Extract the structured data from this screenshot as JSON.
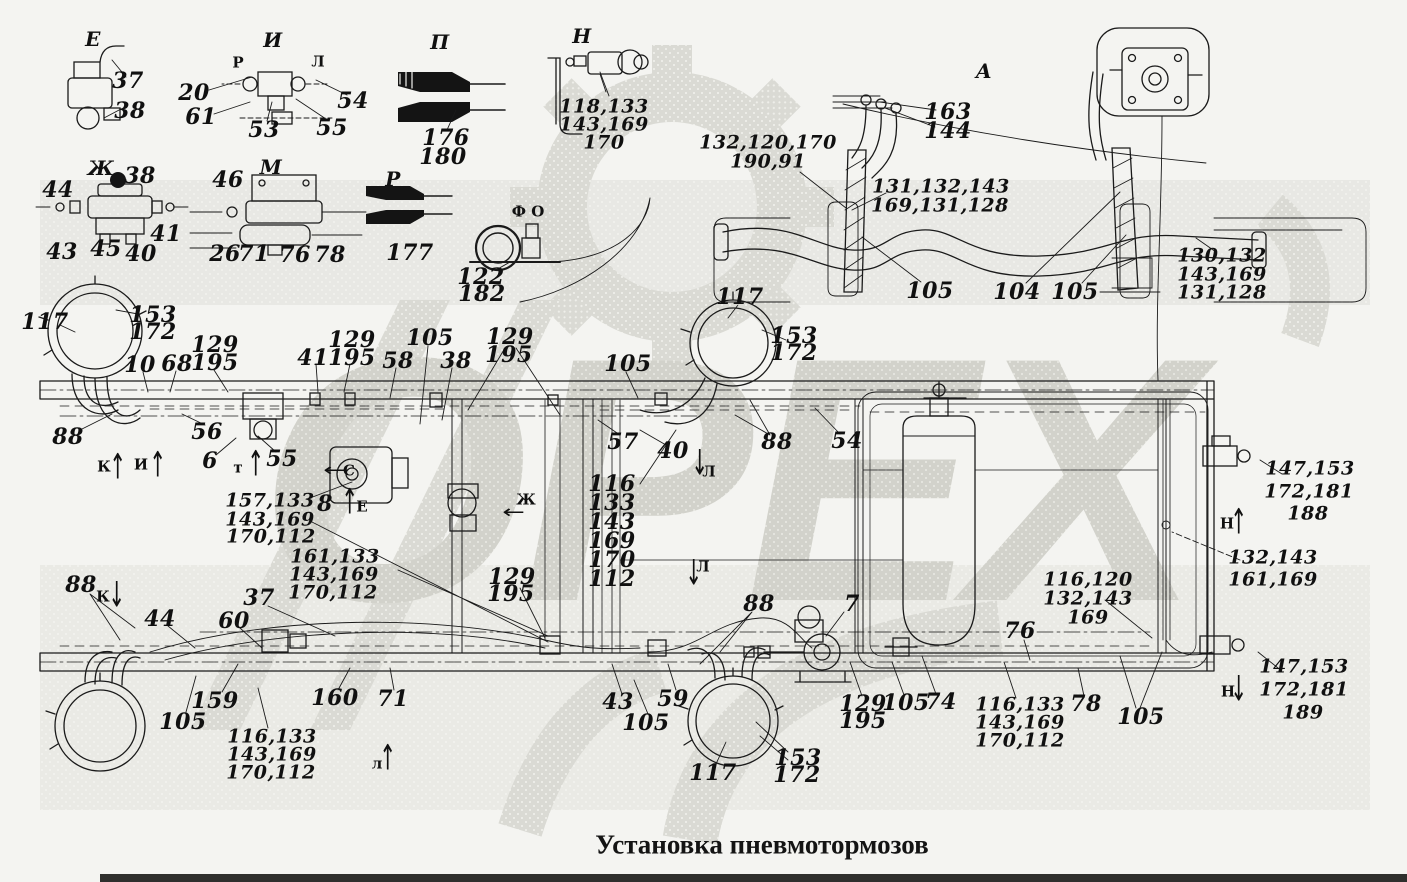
{
  "page": {
    "title": "Установка пневмотормозов",
    "watermark_text": "ОРЕХ",
    "background": "#f4f4f1",
    "line_color": "#1a1a1a",
    "watermark_color": "#d9d9d3"
  },
  "labels": [
    {
      "t": "Е",
      "x": 93,
      "y": 39,
      "c": "letter",
      "n": "view-letter-e-top"
    },
    {
      "t": "37",
      "x": 128,
      "y": 81
    },
    {
      "t": "38",
      "x": 130,
      "y": 111
    },
    {
      "t": "И",
      "x": 273,
      "y": 40,
      "c": "letter",
      "n": "view-letter-i-top"
    },
    {
      "t": "Р",
      "x": 238,
      "y": 63,
      "c": "small",
      "n": "port-letter-r"
    },
    {
      "t": "Л",
      "x": 318,
      "y": 62,
      "c": "small",
      "n": "port-letter-l"
    },
    {
      "t": "20",
      "x": 194,
      "y": 93
    },
    {
      "t": "61",
      "x": 201,
      "y": 117
    },
    {
      "t": "53",
      "x": 264,
      "y": 130
    },
    {
      "t": "55",
      "x": 332,
      "y": 128
    },
    {
      "t": "54",
      "x": 353,
      "y": 101
    },
    {
      "t": "П",
      "x": 440,
      "y": 42,
      "c": "letter",
      "n": "view-letter-p"
    },
    {
      "t": "176",
      "x": 446,
      "y": 138
    },
    {
      "t": "180",
      "x": 443,
      "y": 157
    },
    {
      "t": "Н",
      "x": 582,
      "y": 36,
      "c": "letter",
      "n": "view-letter-n-top"
    },
    {
      "t": "118,133",
      "x": 604,
      "y": 107,
      "c": "m"
    },
    {
      "t": "143,169",
      "x": 604,
      "y": 125,
      "c": "m"
    },
    {
      "t": "170",
      "x": 604,
      "y": 143,
      "c": "m"
    },
    {
      "t": "А",
      "x": 984,
      "y": 71,
      "c": "letter",
      "n": "view-letter-a"
    },
    {
      "t": "163",
      "x": 948,
      "y": 112
    },
    {
      "t": "144",
      "x": 948,
      "y": 131
    },
    {
      "t": "132,120,170",
      "x": 768,
      "y": 143,
      "c": "m"
    },
    {
      "t": "190,91",
      "x": 768,
      "y": 162,
      "c": "m"
    },
    {
      "t": "131,132,143",
      "x": 941,
      "y": 187,
      "c": "m"
    },
    {
      "t": "169,131,128",
      "x": 940,
      "y": 206,
      "c": "m"
    },
    {
      "t": "Ж",
      "x": 101,
      "y": 168,
      "c": "letter",
      "n": "view-letter-zh-top"
    },
    {
      "t": "44",
      "x": 58,
      "y": 190
    },
    {
      "t": "38",
      "x": 140,
      "y": 176
    },
    {
      "t": "43",
      "x": 62,
      "y": 252
    },
    {
      "t": "45",
      "x": 106,
      "y": 249
    },
    {
      "t": "40",
      "x": 141,
      "y": 254
    },
    {
      "t": "41",
      "x": 166,
      "y": 234
    },
    {
      "t": "М",
      "x": 271,
      "y": 167,
      "c": "letter",
      "n": "view-letter-m"
    },
    {
      "t": "46",
      "x": 228,
      "y": 180
    },
    {
      "t": "26",
      "x": 225,
      "y": 254
    },
    {
      "t": "71",
      "x": 254,
      "y": 254
    },
    {
      "t": "76",
      "x": 295,
      "y": 255
    },
    {
      "t": "78",
      "x": 330,
      "y": 255
    },
    {
      "t": "Р",
      "x": 393,
      "y": 179,
      "c": "letter",
      "n": "view-letter-r-mid"
    },
    {
      "t": "177",
      "x": 410,
      "y": 253
    },
    {
      "t": "Ф О",
      "x": 528,
      "y": 212,
      "c": "small",
      "n": "view-letters-f-o"
    },
    {
      "t": "122",
      "x": 481,
      "y": 277
    },
    {
      "t": "182",
      "x": 482,
      "y": 294
    },
    {
      "t": "105",
      "x": 930,
      "y": 291
    },
    {
      "t": "104",
      "x": 1017,
      "y": 292
    },
    {
      "t": "105",
      "x": 1075,
      "y": 292
    },
    {
      "t": "130,132",
      "x": 1222,
      "y": 256,
      "c": "m"
    },
    {
      "t": "143,169",
      "x": 1222,
      "y": 275,
      "c": "m"
    },
    {
      "t": "131,128",
      "x": 1222,
      "y": 293,
      "c": "m"
    },
    {
      "t": "117",
      "x": 45,
      "y": 322
    },
    {
      "t": "153",
      "x": 153,
      "y": 315
    },
    {
      "t": "172",
      "x": 153,
      "y": 332
    },
    {
      "t": "10",
      "x": 140,
      "y": 365
    },
    {
      "t": "68",
      "x": 177,
      "y": 364
    },
    {
      "t": "129",
      "x": 215,
      "y": 345
    },
    {
      "t": "195",
      "x": 215,
      "y": 363
    },
    {
      "t": "88",
      "x": 68,
      "y": 437
    },
    {
      "t": "56",
      "x": 207,
      "y": 432
    },
    {
      "t": "6",
      "x": 210,
      "y": 461
    },
    {
      "t": "55",
      "x": 282,
      "y": 459
    },
    {
      "t": "К",
      "x": 104,
      "y": 467,
      "c": "small",
      "n": "marker-letter-k"
    },
    {
      "t": "↑",
      "x": 118,
      "y": 466,
      "c": "arrow",
      "n": "view-arrow-k-up"
    },
    {
      "t": "И",
      "x": 141,
      "y": 465,
      "c": "small",
      "n": "marker-letter-i"
    },
    {
      "t": "↑",
      "x": 158,
      "y": 464,
      "c": "arrow",
      "n": "view-arrow-i-up"
    },
    {
      "t": "т",
      "x": 238,
      "y": 468,
      "c": "small",
      "n": "marker-letter-t"
    },
    {
      "t": "↑",
      "x": 256,
      "y": 463,
      "c": "arrow",
      "n": "view-arrow-t-up"
    },
    {
      "t": "41",
      "x": 313,
      "y": 358
    },
    {
      "t": "129",
      "x": 352,
      "y": 340
    },
    {
      "t": "195",
      "x": 352,
      "y": 358
    },
    {
      "t": "58",
      "x": 398,
      "y": 361
    },
    {
      "t": "105",
      "x": 430,
      "y": 338
    },
    {
      "t": "38",
      "x": 456,
      "y": 361
    },
    {
      "t": "129",
      "x": 510,
      "y": 337
    },
    {
      "t": "195",
      "x": 509,
      "y": 355
    },
    {
      "t": "105",
      "x": 628,
      "y": 364
    },
    {
      "t": "117",
      "x": 740,
      "y": 297
    },
    {
      "t": "153",
      "x": 794,
      "y": 336
    },
    {
      "t": "172",
      "x": 794,
      "y": 353
    },
    {
      "t": "57",
      "x": 623,
      "y": 442
    },
    {
      "t": "40",
      "x": 673,
      "y": 451
    },
    {
      "t": "88",
      "x": 777,
      "y": 442
    },
    {
      "t": "54",
      "x": 847,
      "y": 441
    },
    {
      "t": "Л",
      "x": 709,
      "y": 472,
      "c": "small",
      "n": "marker-letter-l-mid"
    },
    {
      "t": "↓",
      "x": 700,
      "y": 462,
      "c": "arrow",
      "n": "view-arrow-l-down"
    },
    {
      "t": "Л",
      "x": 703,
      "y": 567,
      "c": "small",
      "n": "marker-letter-l-low"
    },
    {
      "t": "↓",
      "x": 694,
      "y": 572,
      "c": "arrow",
      "n": "view-arrow-l-down2"
    },
    {
      "t": "116",
      "x": 612,
      "y": 484
    },
    {
      "t": "133",
      "x": 612,
      "y": 503
    },
    {
      "t": "143",
      "x": 612,
      "y": 522
    },
    {
      "t": "169",
      "x": 612,
      "y": 541
    },
    {
      "t": "170",
      "x": 612,
      "y": 560
    },
    {
      "t": "112",
      "x": 612,
      "y": 579
    },
    {
      "t": "157,133",
      "x": 270,
      "y": 501,
      "c": "m"
    },
    {
      "t": "143,169",
      "x": 270,
      "y": 520,
      "c": "m"
    },
    {
      "t": "170,112",
      "x": 271,
      "y": 537,
      "c": "m"
    },
    {
      "t": "8",
      "x": 325,
      "y": 504
    },
    {
      "t": "Е",
      "x": 362,
      "y": 507,
      "c": "small",
      "n": "marker-letter-e"
    },
    {
      "t": "↑",
      "x": 350,
      "y": 501,
      "c": "arrow",
      "n": "view-arrow-e-up"
    },
    {
      "t": "С",
      "x": 349,
      "y": 471,
      "c": "small",
      "n": "marker-letter-s"
    },
    {
      "t": "←",
      "x": 335,
      "y": 471,
      "c": "arrowh",
      "n": "view-arrow-s-left"
    },
    {
      "t": "Ж",
      "x": 526,
      "y": 500,
      "c": "small",
      "n": "marker-letter-zh"
    },
    {
      "t": "←",
      "x": 514,
      "y": 513,
      "c": "arrowh",
      "n": "view-arrow-zh-left"
    },
    {
      "t": "161,133",
      "x": 335,
      "y": 557,
      "c": "m"
    },
    {
      "t": "143,169",
      "x": 334,
      "y": 575,
      "c": "m"
    },
    {
      "t": "170,112",
      "x": 333,
      "y": 593,
      "c": "m"
    },
    {
      "t": "129",
      "x": 512,
      "y": 577
    },
    {
      "t": "195",
      "x": 511,
      "y": 594
    },
    {
      "t": "37",
      "x": 259,
      "y": 598
    },
    {
      "t": "147,153",
      "x": 1310,
      "y": 469,
      "c": "m"
    },
    {
      "t": "172,181",
      "x": 1309,
      "y": 492,
      "c": "m"
    },
    {
      "t": "188",
      "x": 1308,
      "y": 514,
      "c": "m"
    },
    {
      "t": "Н",
      "x": 1227,
      "y": 524,
      "c": "small",
      "n": "marker-letter-n-up"
    },
    {
      "t": "↑",
      "x": 1239,
      "y": 521,
      "c": "arrow",
      "n": "view-arrow-n-up"
    },
    {
      "t": "132,143",
      "x": 1273,
      "y": 558,
      "c": "m"
    },
    {
      "t": "161,169",
      "x": 1273,
      "y": 580,
      "c": "m"
    },
    {
      "t": "116,120",
      "x": 1088,
      "y": 580,
      "c": "m"
    },
    {
      "t": "132,143",
      "x": 1088,
      "y": 599,
      "c": "m"
    },
    {
      "t": "169",
      "x": 1088,
      "y": 618,
      "c": "m"
    },
    {
      "t": "76",
      "x": 1020,
      "y": 631
    },
    {
      "t": "88",
      "x": 81,
      "y": 585
    },
    {
      "t": "К",
      "x": 103,
      "y": 597,
      "c": "small",
      "n": "marker-letter-k-low"
    },
    {
      "t": "↓",
      "x": 117,
      "y": 594,
      "c": "arrow",
      "n": "view-arrow-k-down"
    },
    {
      "t": "44",
      "x": 160,
      "y": 619
    },
    {
      "t": "60",
      "x": 234,
      "y": 621
    },
    {
      "t": "159",
      "x": 215,
      "y": 701
    },
    {
      "t": "105",
      "x": 183,
      "y": 722
    },
    {
      "t": "160",
      "x": 335,
      "y": 698
    },
    {
      "t": "71",
      "x": 393,
      "y": 699
    },
    {
      "t": "116,133",
      "x": 272,
      "y": 737,
      "c": "m"
    },
    {
      "t": "143,169",
      "x": 272,
      "y": 755,
      "c": "m"
    },
    {
      "t": "170,112",
      "x": 271,
      "y": 773,
      "c": "m"
    },
    {
      "t": "л",
      "x": 377,
      "y": 764,
      "c": "small",
      "n": "marker-letter-l-bot"
    },
    {
      "t": "↑",
      "x": 388,
      "y": 757,
      "c": "arrow",
      "n": "view-arrow-l-up"
    },
    {
      "t": "43",
      "x": 618,
      "y": 702
    },
    {
      "t": "105",
      "x": 646,
      "y": 723
    },
    {
      "t": "59",
      "x": 673,
      "y": 699
    },
    {
      "t": "117",
      "x": 713,
      "y": 773
    },
    {
      "t": "153",
      "x": 798,
      "y": 758
    },
    {
      "t": "172",
      "x": 797,
      "y": 775
    },
    {
      "t": "88",
      "x": 759,
      "y": 604
    },
    {
      "t": "7",
      "x": 852,
      "y": 604
    },
    {
      "t": "129",
      "x": 863,
      "y": 704
    },
    {
      "t": "195",
      "x": 863,
      "y": 721
    },
    {
      "t": "105",
      "x": 906,
      "y": 703
    },
    {
      "t": "74",
      "x": 941,
      "y": 702
    },
    {
      "t": "116,133",
      "x": 1020,
      "y": 705,
      "c": "m"
    },
    {
      "t": "143,169",
      "x": 1020,
      "y": 723,
      "c": "m"
    },
    {
      "t": "170,112",
      "x": 1020,
      "y": 741,
      "c": "m"
    },
    {
      "t": "78",
      "x": 1086,
      "y": 704
    },
    {
      "t": "105",
      "x": 1141,
      "y": 717
    },
    {
      "t": "147,153",
      "x": 1304,
      "y": 667,
      "c": "m"
    },
    {
      "t": "172,181",
      "x": 1304,
      "y": 690,
      "c": "m"
    },
    {
      "t": "189",
      "x": 1303,
      "y": 713,
      "c": "m"
    },
    {
      "t": "Н",
      "x": 1228,
      "y": 692,
      "c": "small",
      "n": "marker-letter-n-low"
    },
    {
      "t": "↓",
      "x": 1239,
      "y": 688,
      "c": "arrow",
      "n": "view-arrow-n-down"
    }
  ]
}
